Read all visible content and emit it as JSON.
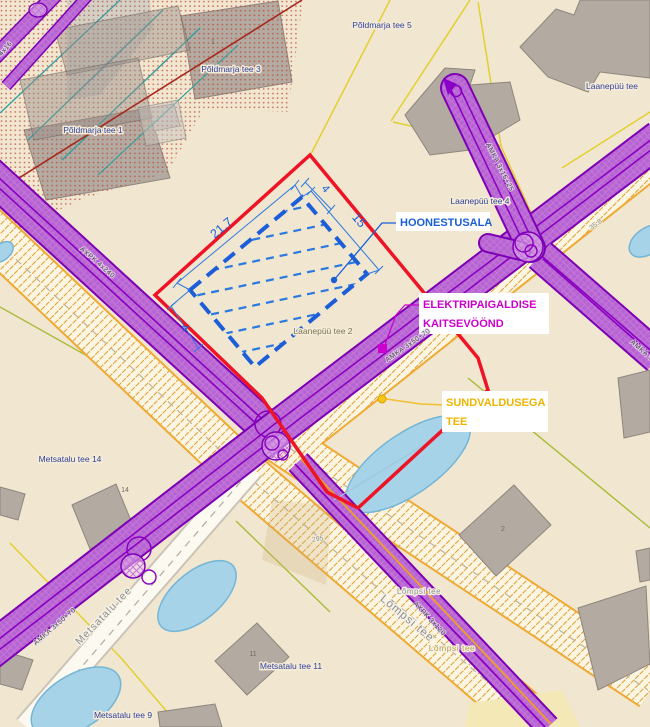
{
  "annotations": {
    "hoonestusala": "HOONESTUSALA",
    "kaitsevoond_line1": "ELEKTRIPAIGALDISE",
    "kaitsevoond_line2": "KAITSEVÖÖND",
    "sundvaldus_line1": "SUNDVALDUSEGA",
    "sundvaldus_line2": "TEE"
  },
  "dimensions": {
    "length": "21,7",
    "width": "15",
    "setback_ne": "4",
    "setback_sw": "4"
  },
  "addresses": {
    "poldmarja_tee_5": "Põldmarja tee 5",
    "poldmarja_tee_3": "Põldmarja tee 3",
    "poldmarja_tee_1": "Põldmarja tee 1",
    "laanepuu_tee": "Laanepüü tee",
    "laanepuu_tee_4": "Laanepüü tee 4",
    "laanepuu_tee_2": "Laanepüü tee 2",
    "metsatalu_tee_14": "Metsatalu tee 14",
    "metsatalu_tee_11": "Metsatalu tee 11",
    "metsatalu_tee_9": "Metsatalu tee 9"
  },
  "road_names": {
    "metsatalu_tee": "Metsatalu tee",
    "lompsi_tee_large": "Lõmpsi tee",
    "lompsi_tee_small": "Lõmpsi tee",
    "lompsi_tee_edge": "Lõmpsi tee"
  },
  "cable_labels": {
    "axpk_4x240": "AXPK 4x240",
    "amka_3x50_70_upper": "AMKA 3x50+70",
    "amka_3x50_70_lower": "AMKA 3x50+70",
    "amka_3x16_25": "AMKA 3x16+25",
    "axpk_3x120": "AXPK 3x120",
    "amka_edge": "AMKA 3x",
    "corner_4x16": "4x16"
  },
  "measurements": {
    "road_35_8": "35.8",
    "parcel_295": "295"
  },
  "house_numbers": {
    "no_1": "1",
    "no_14": "14",
    "no_11": "11",
    "no_2": "2"
  },
  "colors": {
    "boundary_red": "#ee1325",
    "building_area_blue": "#1a5fd6",
    "protection_zone_purple": "#8b00c8",
    "kaitsevoond_magenta": "#cc00cc",
    "sundvaldus_yellow": "#eeb400",
    "water_blue": "#a6d3e8",
    "background_beige": "#f1e6d0"
  }
}
